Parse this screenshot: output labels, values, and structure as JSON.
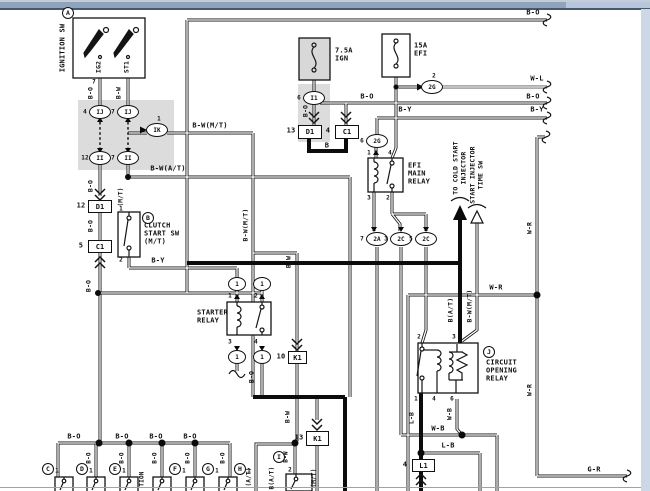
{
  "window": {
    "titlebar_color": "#8fa3ba",
    "titlebar_highlight": "#c3cdd9",
    "titlebar_light_segment": "#b7c6da",
    "titlebar_edge_color": "#46586e",
    "right_edge_color": "#ccd7e7",
    "bottom_rule_color": "#9aa4ae",
    "page_bg": "#ffffff",
    "ink": "#141414",
    "shade": "#dcdcdc"
  },
  "components": {
    "ignition_switch": "IGNITION SW",
    "clutch_start_switch": "CLUTCH START SW (M/T)",
    "starter_relay": "STARTER RELAY",
    "efi_main_relay": "EFI MAIN RELAY",
    "circuit_opening_relay": "CIRCUIT OPENING RELAY",
    "fuse_ign": "7.5A IGN",
    "fuse_efi": "15A EFI",
    "destination_1": "TO COLD START INJECTOR",
    "destination_2": "START INJECTOR TIME SW"
  },
  "labels": [
    {
      "t": "IGNITION SW",
      "x": 63,
      "y": 48,
      "r": 1
    },
    {
      "t": "IG2",
      "x": 99,
      "y": 67,
      "r": 1,
      "s": 6.5
    },
    {
      "t": "ST1",
      "x": 127,
      "y": 67,
      "r": 1,
      "s": 6.5
    },
    {
      "t": "7",
      "x": 94,
      "y": 82,
      "s": 6
    },
    {
      "t": "B-O",
      "x": 91,
      "y": 93,
      "r": 1,
      "s": 6.5
    },
    {
      "t": "B-W",
      "x": 119,
      "y": 93,
      "r": 1,
      "s": 6.5
    },
    {
      "t": "B-W(M/T)",
      "x": 210,
      "y": 126
    },
    {
      "t": "B-W(A/T)",
      "x": 168,
      "y": 169
    },
    {
      "t": "B-O",
      "x": 91,
      "y": 186,
      "r": 1,
      "s": 6.5
    },
    {
      "t": "B-O",
      "x": 91,
      "y": 226,
      "r": 1,
      "s": 6.5
    },
    {
      "t": "(M/T)",
      "x": 121,
      "y": 197,
      "r": 1,
      "s": 6
    },
    {
      "t": "1",
      "x": 121,
      "y": 209,
      "s": 6
    },
    {
      "t": "2",
      "x": 121,
      "y": 260,
      "s": 6
    },
    {
      "t": "CLUTCH",
      "x": 144,
      "y": 226,
      "a": 1
    },
    {
      "t": "START SW",
      "x": 144,
      "y": 234,
      "a": 1
    },
    {
      "t": "(M/T)",
      "x": 144,
      "y": 242,
      "a": 1
    },
    {
      "t": "B-Y",
      "x": 158,
      "y": 261
    },
    {
      "t": "B-O",
      "x": 89,
      "y": 286,
      "r": 1,
      "s": 6.5
    },
    {
      "t": "STARTER",
      "x": 197,
      "y": 313,
      "a": 1
    },
    {
      "t": "RELAY",
      "x": 197,
      "y": 321,
      "a": 1
    },
    {
      "t": "1",
      "x": 230,
      "y": 296,
      "s": 6
    },
    {
      "t": "2",
      "x": 256,
      "y": 296,
      "s": 6
    },
    {
      "t": "3",
      "x": 230,
      "y": 342,
      "s": 6
    },
    {
      "t": "4",
      "x": 256,
      "y": 342,
      "s": 6
    },
    {
      "t": "B-O",
      "x": 252,
      "y": 377,
      "r": 1,
      "s": 6.5
    },
    {
      "t": "B",
      "x": 327,
      "y": 146
    },
    {
      "t": "7.5A",
      "x": 335,
      "y": 51,
      "a": 1
    },
    {
      "t": "IGN",
      "x": 335,
      "y": 59,
      "a": 1
    },
    {
      "t": "15A",
      "x": 414,
      "y": 46,
      "a": 1
    },
    {
      "t": "EFI",
      "x": 414,
      "y": 54,
      "a": 1
    },
    {
      "t": "B-O",
      "x": 306,
      "y": 111,
      "r": 1,
      "s": 6.5
    },
    {
      "t": "B-O",
      "x": 367,
      "y": 97
    },
    {
      "t": "B-O",
      "x": 533,
      "y": 97
    },
    {
      "t": "B-O",
      "x": 533,
      "y": 13
    },
    {
      "t": "W-L",
      "x": 537,
      "y": 79
    },
    {
      "t": "B-Y",
      "x": 405,
      "y": 110
    },
    {
      "t": "B-Y",
      "x": 537,
      "y": 110
    },
    {
      "t": "EFI",
      "x": 408,
      "y": 166,
      "a": 1
    },
    {
      "t": "MAIN",
      "x": 408,
      "y": 174,
      "a": 1
    },
    {
      "t": "RELAY",
      "x": 408,
      "y": 182,
      "a": 1
    },
    {
      "t": "1",
      "x": 369,
      "y": 153,
      "s": 6
    },
    {
      "t": "4",
      "x": 390,
      "y": 153,
      "s": 6
    },
    {
      "t": "3",
      "x": 369,
      "y": 198,
      "s": 6
    },
    {
      "t": "2",
      "x": 388,
      "y": 198,
      "s": 6
    },
    {
      "t": "TO COLD START",
      "x": 456,
      "y": 168,
      "r": 1,
      "s": 6.5
    },
    {
      "t": "INJECTOR",
      "x": 464,
      "y": 168,
      "r": 1,
      "s": 6.5
    },
    {
      "t": "START INJECTOR",
      "x": 473,
      "y": 175,
      "r": 1,
      "s": 6.5
    },
    {
      "t": "TIME SW",
      "x": 481,
      "y": 175,
      "r": 1,
      "s": 6.5
    },
    {
      "t": "B(A/T)",
      "x": 451,
      "y": 310,
      "r": 1,
      "s": 6.5
    },
    {
      "t": "B-W(M/T)",
      "x": 470,
      "y": 306,
      "r": 1,
      "s": 6.5
    },
    {
      "t": "W-R",
      "x": 496,
      "y": 288
    },
    {
      "t": "W-R",
      "x": 530,
      "y": 228,
      "r": 1,
      "s": 6.5
    },
    {
      "t": "W-R",
      "x": 530,
      "y": 390,
      "r": 1,
      "s": 6.5
    },
    {
      "t": "2",
      "x": 419,
      "y": 337,
      "s": 6
    },
    {
      "t": "3",
      "x": 454,
      "y": 337,
      "s": 6
    },
    {
      "t": "1",
      "x": 416,
      "y": 399,
      "s": 6
    },
    {
      "t": "4",
      "x": 434,
      "y": 399,
      "s": 6
    },
    {
      "t": "6",
      "x": 452,
      "y": 399,
      "s": 6
    },
    {
      "t": "CIRCUIT",
      "x": 486,
      "y": 363,
      "a": 1
    },
    {
      "t": "OPENING",
      "x": 486,
      "y": 371,
      "a": 1
    },
    {
      "t": "RELAY",
      "x": 486,
      "y": 379,
      "a": 1
    },
    {
      "t": "W-B",
      "x": 450,
      "y": 414,
      "r": 1,
      "s": 6.5
    },
    {
      "t": "W-B",
      "x": 438,
      "y": 429
    },
    {
      "t": "L-B",
      "x": 412,
      "y": 418,
      "r": 1,
      "s": 6.5
    },
    {
      "t": "L-B",
      "x": 448,
      "y": 446
    },
    {
      "t": "G-R",
      "x": 594,
      "y": 470
    },
    {
      "t": "B-W",
      "x": 289,
      "y": 262,
      "r": 1,
      "s": 6.5
    },
    {
      "t": "B-W",
      "x": 288,
      "y": 417,
      "r": 1,
      "s": 6.5
    },
    {
      "t": "B-W(M/T)",
      "x": 246,
      "y": 225,
      "r": 1,
      "s": 6.5
    },
    {
      "t": "(A/T)",
      "x": 249,
      "y": 477,
      "r": 1,
      "s": 6
    },
    {
      "t": "B-W",
      "x": 286,
      "y": 457,
      "r": 1,
      "s": 6
    },
    {
      "t": "2",
      "x": 290,
      "y": 470,
      "s": 6
    },
    {
      "t": "B(A/T)",
      "x": 272,
      "y": 478,
      "r": 1,
      "s": 6
    },
    {
      "t": "(M/T)",
      "x": 314,
      "y": 478,
      "r": 1,
      "s": 6
    },
    {
      "t": "B-O",
      "x": 74,
      "y": 437
    },
    {
      "t": "B-O",
      "x": 122,
      "y": 437
    },
    {
      "t": "B-O",
      "x": 156,
      "y": 437
    },
    {
      "t": "B-O",
      "x": 190,
      "y": 437
    },
    {
      "t": "B-O",
      "x": 89,
      "y": 458,
      "r": 1,
      "s": 6
    },
    {
      "t": "B-O",
      "x": 122,
      "y": 458,
      "r": 1,
      "s": 6
    },
    {
      "t": "B-O",
      "x": 155,
      "y": 458,
      "r": 1,
      "s": 6
    },
    {
      "t": "B-O",
      "x": 188,
      "y": 458,
      "r": 1,
      "s": 6
    },
    {
      "t": "B-O",
      "x": 223,
      "y": 458,
      "r": 1,
      "s": 6
    },
    {
      "t": "1",
      "x": 57,
      "y": 471,
      "s": 6
    },
    {
      "t": "1",
      "x": 91,
      "y": 471,
      "s": 6
    },
    {
      "t": "1",
      "x": 124,
      "y": 471,
      "s": 6
    },
    {
      "t": "1",
      "x": 184,
      "y": 471,
      "s": 6
    },
    {
      "t": "1",
      "x": 217,
      "y": 471,
      "s": 6
    },
    {
      "t": "1",
      "x": 249,
      "y": 471,
      "s": 6
    },
    {
      "t": "TION",
      "x": 142,
      "y": 479,
      "r": 1,
      "s": 6
    }
  ],
  "circles": [
    {
      "l": "A",
      "x": 68,
      "y": 13
    },
    {
      "l": "B",
      "x": 148,
      "y": 218
    },
    {
      "l": "J",
      "x": 489,
      "y": 352
    },
    {
      "l": "C",
      "x": 48,
      "y": 469
    },
    {
      "l": "D",
      "x": 82,
      "y": 469
    },
    {
      "l": "E",
      "x": 115,
      "y": 469
    },
    {
      "l": "F",
      "x": 175,
      "y": 469
    },
    {
      "l": "G",
      "x": 208,
      "y": 469
    },
    {
      "l": "H",
      "x": 240,
      "y": 469
    },
    {
      "l": "I",
      "x": 279,
      "y": 457
    }
  ],
  "conn_boxes": [
    {
      "n": "12",
      "l": "D1",
      "x": 88,
      "y": 200,
      "w": 22,
      "h": 11
    },
    {
      "n": "5",
      "l": "C1",
      "x": 88,
      "y": 240,
      "w": 22,
      "h": 11
    },
    {
      "n": "13",
      "l": "D1",
      "x": 298,
      "y": 125,
      "w": 22,
      "h": 12
    },
    {
      "n": "4",
      "l": "C1",
      "x": 335,
      "y": 125,
      "w": 22,
      "h": 12
    },
    {
      "n": "10",
      "l": "K1",
      "x": 288,
      "y": 351,
      "w": 17,
      "h": 11
    },
    {
      "n": "13",
      "l": "K1",
      "x": 306,
      "y": 431,
      "w": 21,
      "h": 13
    },
    {
      "n": "4",
      "l": "L1",
      "x": 412,
      "y": 459,
      "w": 21,
      "h": 11
    }
  ],
  "ovals": [
    {
      "n": "4",
      "l": "IJ",
      "x": 100,
      "y": 112,
      "p": "l"
    },
    {
      "n": "7",
      "l": "IJ",
      "x": 128,
      "y": 112,
      "p": "l"
    },
    {
      "n": "12",
      "l": "II",
      "x": 100,
      "y": 158,
      "p": "l"
    },
    {
      "n": "7",
      "l": "II",
      "x": 128,
      "y": 158,
      "p": "l"
    },
    {
      "n": "1",
      "l": "IK",
      "x": 157,
      "y": 130,
      "p": "t"
    },
    {
      "n": "6",
      "l": "I1",
      "x": 314,
      "y": 98,
      "p": "l"
    },
    {
      "n": "2",
      "l": "2G",
      "x": 432,
      "y": 87,
      "p": "t"
    },
    {
      "n": "6",
      "l": "2G",
      "x": 377,
      "y": 141,
      "p": "l"
    },
    {
      "n": "7",
      "l": "2A",
      "x": 377,
      "y": 239,
      "p": "l"
    },
    {
      "n": "3",
      "l": "2C",
      "x": 401,
      "y": 239,
      "p": "l"
    },
    {
      "n": "5",
      "l": "2C",
      "x": 426,
      "y": 239,
      "p": "l"
    },
    {
      "n": "",
      "l": "1",
      "x": 237,
      "y": 284
    },
    {
      "n": "",
      "l": "1",
      "x": 262,
      "y": 284
    },
    {
      "n": "",
      "l": "1",
      "x": 237,
      "y": 357
    },
    {
      "n": "",
      "l": "1",
      "x": 262,
      "y": 357
    }
  ]
}
